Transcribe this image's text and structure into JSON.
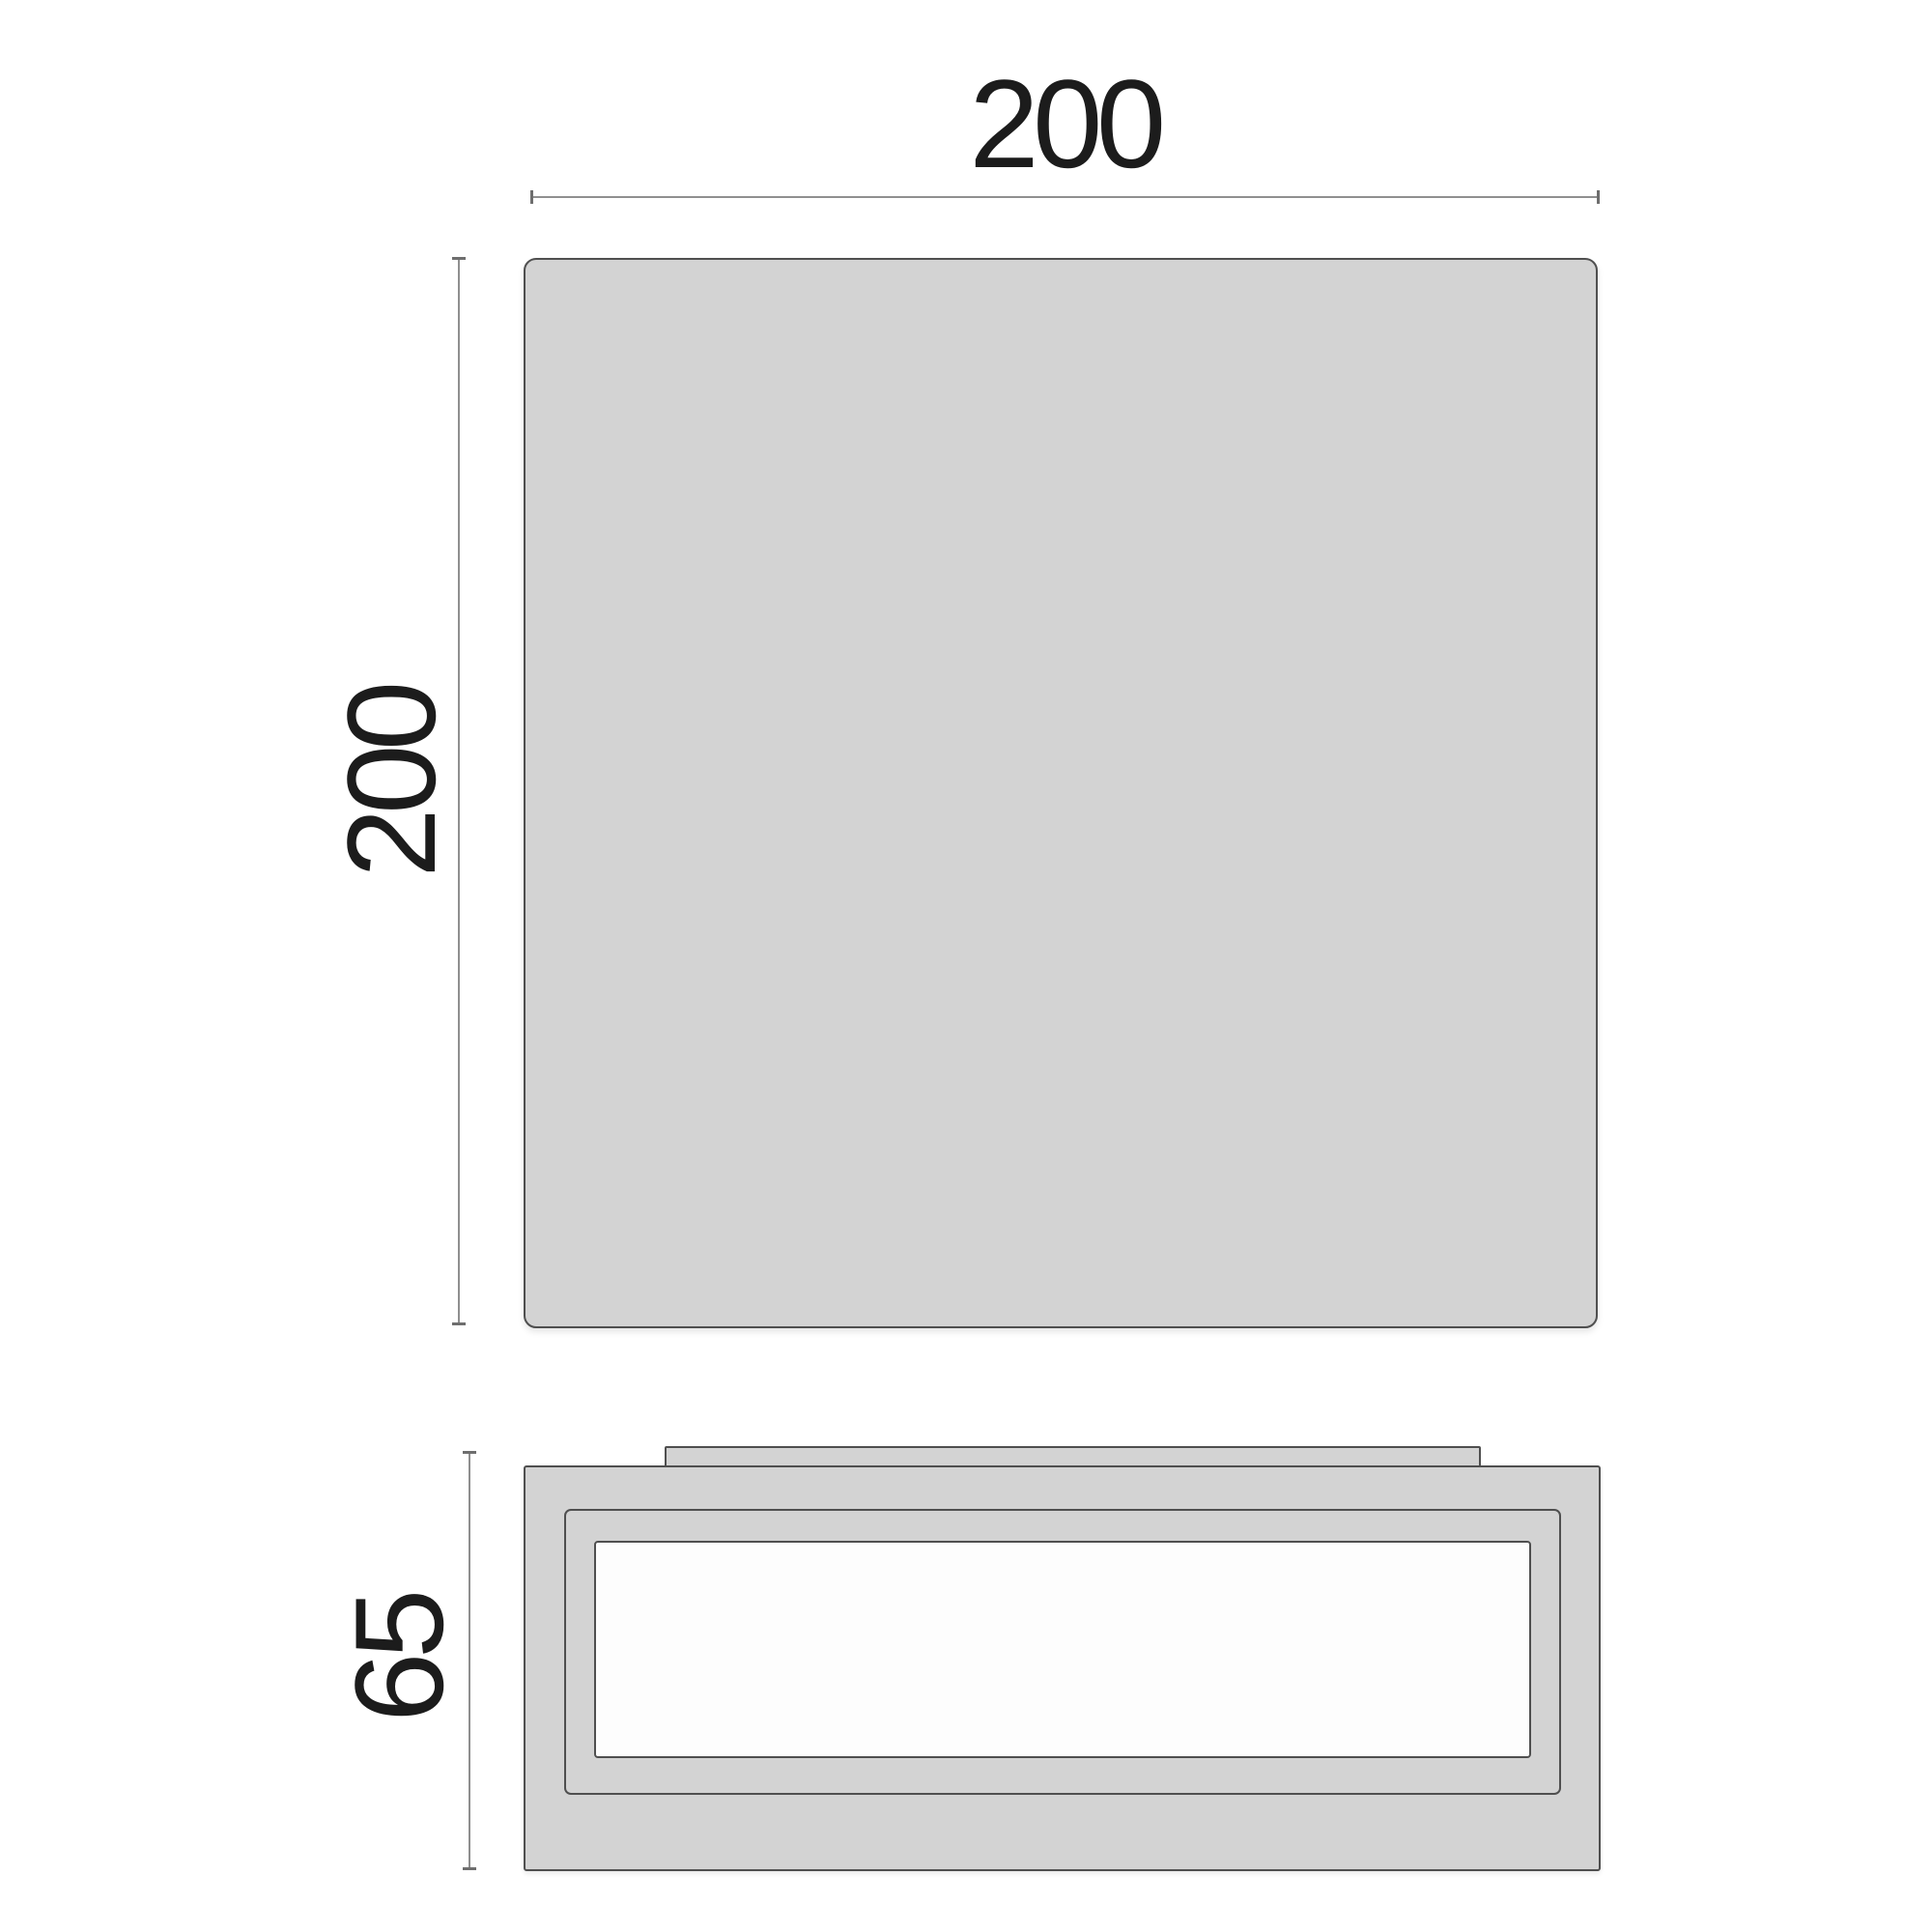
{
  "theme": {
    "canvas-bg": "#ffffff",
    "panel-fill": "#d3d3d3",
    "panel-border": "#4f4f4f",
    "dim-line": "#8f8f8f",
    "dim-tick": "#6e6e6e",
    "label-color": "#1c1c1c",
    "diffuser-fill": "#fdfdfd"
  },
  "drawing": {
    "type": "technical-dimension-drawing",
    "top_view": {
      "width_label": "200",
      "height_label": "200"
    },
    "side_view": {
      "height_label": "65"
    }
  }
}
